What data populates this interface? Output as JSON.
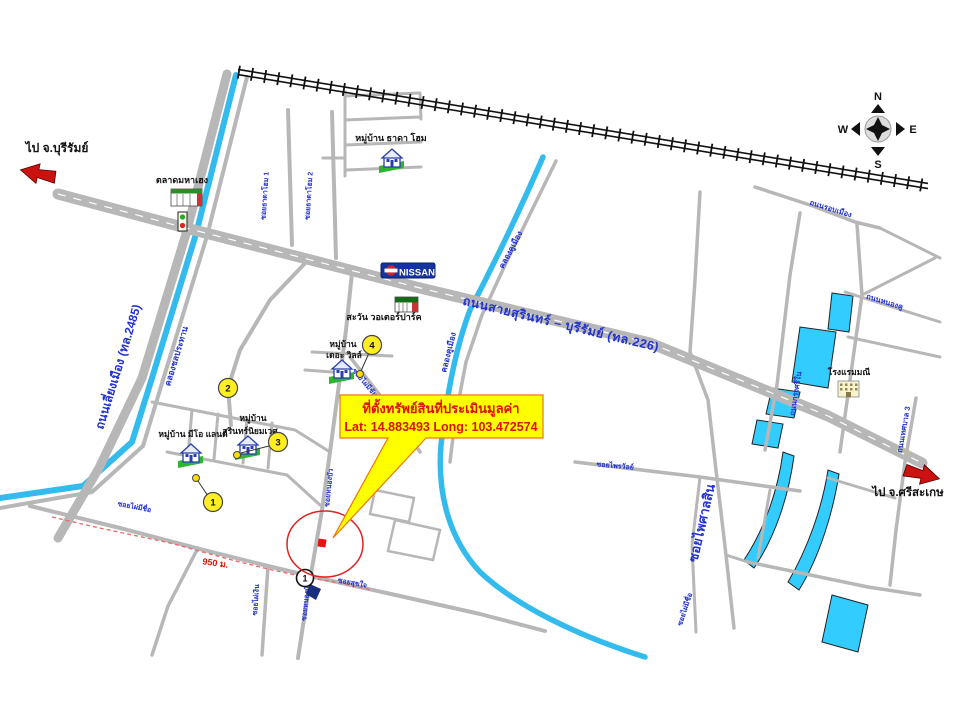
{
  "compass": {
    "north": "N",
    "south": "S",
    "east": "E",
    "west": "W"
  },
  "arrows": {
    "left": "ไป จ.บุรีรัมย์",
    "right": "ไป จ.ศรีสะเกษ"
  },
  "callout": {
    "line1": "ที่ตั้งทรัพย์สินที่ประเมินมูลค่า",
    "line2": "Lat: 14.883493  Long: 103.472574"
  },
  "distance": "950 ม.",
  "brand": {
    "nissan": "NISSAN"
  },
  "places": {
    "market": "ตลาดมหาเฮง",
    "village_thada": "หมู่บ้าน ธาดา โฮม",
    "waterpark": "สะวัน วอเตอร์ปาร์ค",
    "village_ville_1": "หมู่บ้าน",
    "village_ville_2": "เดอะ วิลล์",
    "village_surin_1": "หมู่บ้าน",
    "village_surin_2": "สุรินทร์นิยมเวศ",
    "village_meo": "หมู่บ้าน มีโอ แลนด์",
    "hotel": "โรงแรมมณี"
  },
  "roads": {
    "highway": "ถนนสายสุรินทร์ – บุรีรัมย์ (ทล.226)",
    "bypass": "ถนนเลี่ยงเมือง (ทล.2485)",
    "soi_thada_1": "ซอยธาดาโฮม 1",
    "soi_thada_2": "ซอยธาดาโฮม 2",
    "thanon_ropmueang": "ถนนรอบเมือง",
    "thanon_nongkhu": "ถนนหนองคู",
    "thanon_krungsi": "ถนนกรุงศรีใน",
    "thanon_thesaban3": "ถนนเทศบาล 3",
    "soi_phaisansin": "ซอยไพศาลสิน",
    "soi_phaimichue": "ซอยไผ่มีชื่อ",
    "soi_phaimichai": "ซอยไผ่มีชัย",
    "soi_phaingoen": "ซอยไผ่เงิน",
    "soi_nongbua": "ซอยหนองบัว",
    "soi_sukjai": "ซอยสุขใจ",
    "soi_phairawan": "ซอยไพรวัลย์"
  },
  "canals": {
    "irrigation": "คลองชลประทาน",
    "khumueang": "คลองคูเมือง"
  },
  "markers": {
    "m1": "1",
    "m2": "2",
    "m3": "3",
    "m4": "4",
    "junction": "1"
  }
}
